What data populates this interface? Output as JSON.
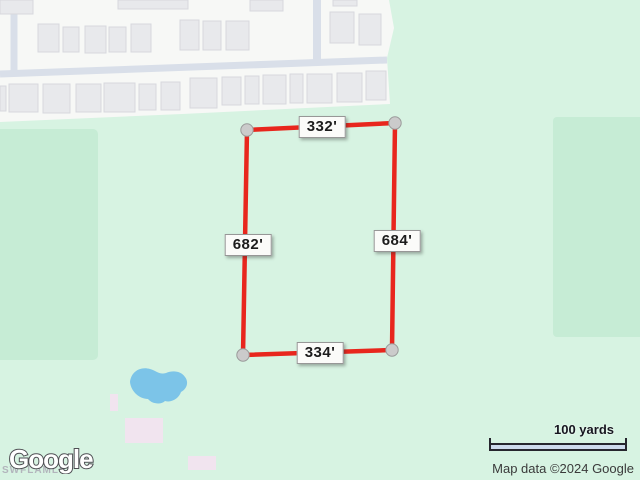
{
  "map": {
    "scale_bar_label": "100 yards",
    "attribution_text": "Map data ©2024 Google",
    "logo_text": "Google",
    "watermark_text": "SWFLAMLS"
  },
  "parcel": {
    "line_color": "#e8261d",
    "vertex_fill": "#cbcbcb",
    "vertex_stroke": "#9b9b9b",
    "corners": {
      "top_left": [
        247,
        130
      ],
      "top_right": [
        395,
        123
      ],
      "bottom_right": [
        392,
        350
      ],
      "bottom_left": [
        243,
        355
      ]
    },
    "measurements": {
      "top": {
        "text": "332'",
        "x": 322,
        "y": 127
      },
      "left": {
        "text": "682'",
        "x": 248,
        "y": 245
      },
      "right": {
        "text": "684'",
        "x": 397,
        "y": 241
      },
      "bottom": {
        "text": "334'",
        "x": 320,
        "y": 353
      }
    }
  },
  "colors": {
    "land": "#d7f3e2",
    "park": "#c6ecd5",
    "urban": "#f7f8f6",
    "road": "#d9dfe9",
    "building_fill": "#e8e9ec",
    "building_stroke": "#d7d8dd",
    "water": "#7cc4e8",
    "poi": "#f1e4ef",
    "scale_fill": "#cddaec",
    "scale_stroke": "#26262e"
  }
}
